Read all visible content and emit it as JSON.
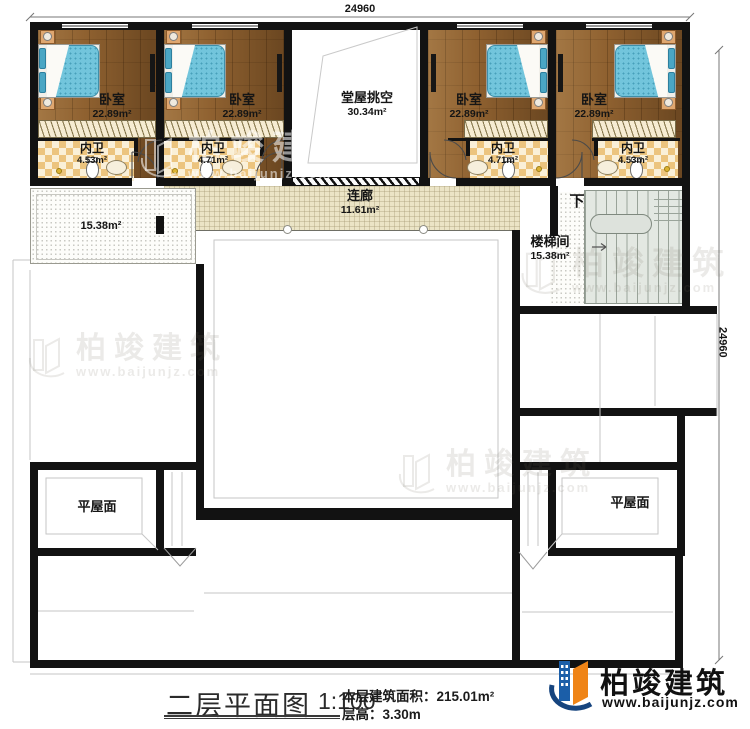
{
  "title_block": {
    "plan_title": "二层平面图",
    "scale": "1:100",
    "area_label": "本层建筑面积：",
    "area_value": "215.01m²",
    "floor_height_label": "层高：",
    "floor_height_value": "3.30m"
  },
  "dimensions": {
    "top": "24960",
    "right": "24960"
  },
  "rooms": {
    "bedrooms": [
      {
        "name": "卧室",
        "area": "22.89m²"
      },
      {
        "name": "卧室",
        "area": "22.89m²"
      },
      {
        "name": "卧室",
        "area": "22.89m²"
      },
      {
        "name": "卧室",
        "area": "22.89m²"
      }
    ],
    "baths": [
      {
        "name": "内卫",
        "area": "4.53m²"
      },
      {
        "name": "内卫",
        "area": "4.71m²"
      },
      {
        "name": "内卫",
        "area": "4.71m²"
      },
      {
        "name": "内卫",
        "area": "4.53m²"
      }
    ],
    "hall_void": {
      "name": "堂屋挑空",
      "area": "30.34m²"
    },
    "corridor": {
      "name": "连廊",
      "area": "11.61m²"
    },
    "stairwell": {
      "name": "楼梯间",
      "area": "15.38m²",
      "down": "下"
    },
    "terrace": {
      "area": "15.38m²"
    },
    "flat_roof_left": {
      "name": "平屋面"
    },
    "flat_roof_right": {
      "name": "平屋面"
    }
  },
  "brand": {
    "name": "柏竣建筑",
    "site": "www.baijunjz.com"
  },
  "colors": {
    "wall": "#121212",
    "wood": "#8f6130",
    "bed": "#72c5dc",
    "checker": "#ecc47e",
    "corridor": "#ebe4c6",
    "logo_blue": "#1b5ea8",
    "logo_orange": "#ef8417"
  }
}
